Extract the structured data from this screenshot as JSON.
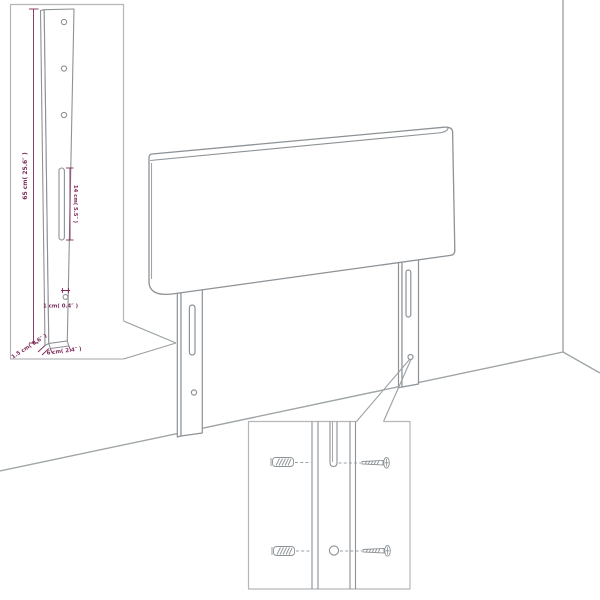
{
  "dims": {
    "leg_height": "65 cm( 25.6″ )",
    "slot_length": "14 cm( 5.5″ )",
    "hole_diameter": "1 cm( 0.4″ )",
    "leg_depth": "1.5 cm( 0.6″ )",
    "leg_width": "6 cm( 2.4″ )"
  },
  "colors": {
    "dimension_text": "#7e2a5a",
    "drawing_line": "#8d9296",
    "callout_border": "#b4b7b9",
    "background": "#ffffff"
  }
}
